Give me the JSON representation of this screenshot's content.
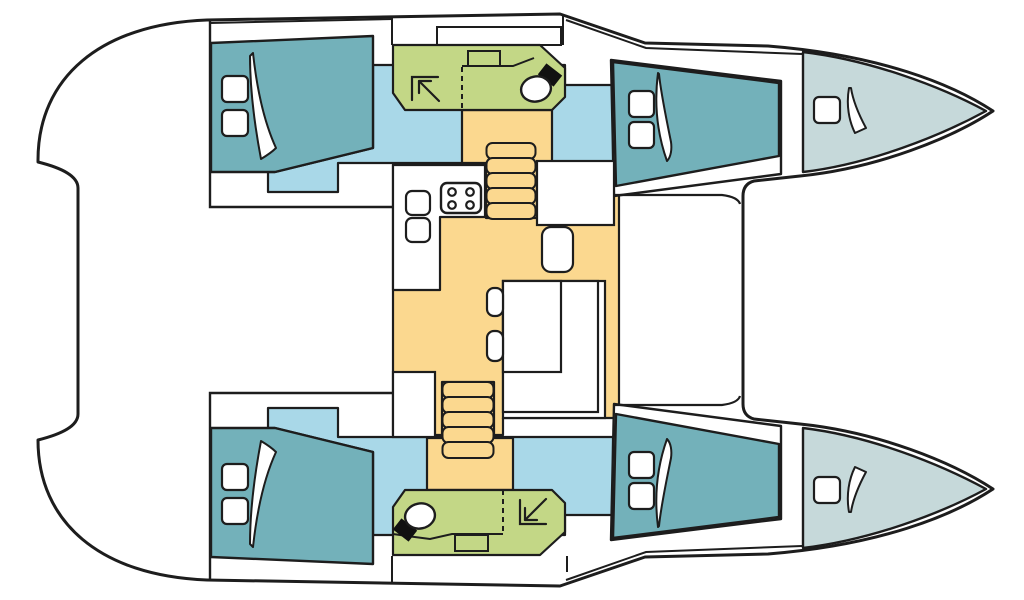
{
  "title": "Catamaran interior layout floor plan (top view, bow to the right)",
  "colors": {
    "line": "#1d1d1d",
    "deck": "#ffffff",
    "bed": "#73b1ba",
    "floor": "#a9d8e8",
    "bath": "#c3d786",
    "salon": "#fbd88f",
    "bow": "#c6d9da",
    "black": "#111111",
    "none": "none"
  },
  "rooms": [
    {
      "id": "port-aft-cabin",
      "label": "Aft cabin (port)"
    },
    {
      "id": "port-bathroom",
      "label": "Bathroom with shower and toilet (port)"
    },
    {
      "id": "port-forward-cabin",
      "label": "Forward cabin (port)"
    },
    {
      "id": "port-bow-locker",
      "label": "Bow berth / locker (port)"
    },
    {
      "id": "starboard-aft-cabin",
      "label": "Aft cabin (starboard)"
    },
    {
      "id": "starboard-bathroom",
      "label": "Bathroom with shower and toilet (starboard)"
    },
    {
      "id": "starboard-forward-cabin",
      "label": "Forward cabin (starboard)"
    },
    {
      "id": "starboard-bow-locker",
      "label": "Bow berth / locker (starboard)"
    },
    {
      "id": "salon",
      "label": "Salon with galley, dinette and chart seat"
    }
  ],
  "fixtures": [
    "double-bed",
    "pillow",
    "blanket-fold",
    "shower-arrow",
    "toilet",
    "washbasin",
    "galley-sink",
    "four-burner-stove",
    "staircase-steps",
    "dinette-table",
    "bench-seat",
    "storage-cabinet"
  ]
}
